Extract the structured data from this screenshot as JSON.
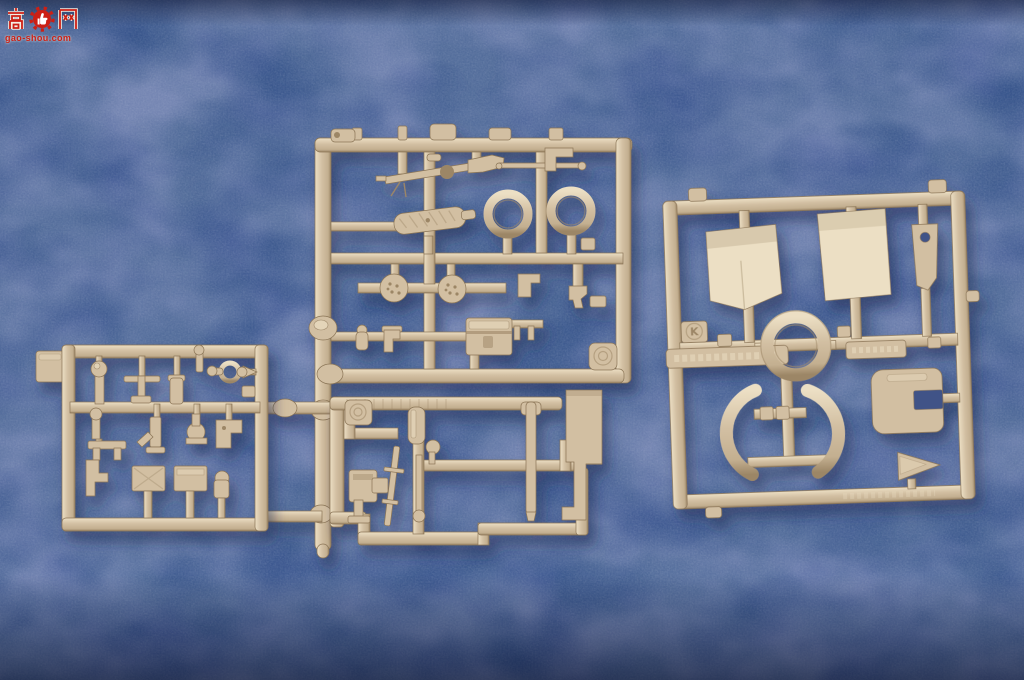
{
  "meta": {
    "scene": "Top-down photograph of four tan injection-moulded plastic model-kit sprues (part trees) lying on a blue textured paper background",
    "lighting": "soft light from upper-left, sprues cast soft blue shadows, darker vignette at top edge and bottom of photo"
  },
  "watermark": {
    "characters": "高网",
    "char_left": "高",
    "char_right": "网",
    "icon": "red gear with white thumbs-up",
    "site_text": "gao-shou.com"
  },
  "colors": {
    "bg_blue": "#4d639c",
    "bg_blue_light": "#7488b7",
    "bg_blue_dark": "#394e80",
    "bg_hole": "#3f5387",
    "sprue_base": "#d2bfa2",
    "sprue_hi": "#ecdfc4",
    "sprue_mid": "#c3af90",
    "sprue_shade": "#9c8666",
    "sprue_edge": "#8a7456",
    "shadow": "#1d2950",
    "watermark_red": "#cc1f14",
    "watermark_outline": "#f5efe4"
  },
  "sprues": {
    "top_center": {
      "letter": "",
      "description": "large square sprue with weapon and fitting parts, long runner extending down its left side to the other sprues",
      "parts": [
        "machine-gun",
        "thin-rod",
        "l-bracket",
        "cast-textured-muffler",
        "ring-hoop-left",
        "ring-hoop-right",
        "stippled-disc-left",
        "stippled-disc-right",
        "small-bracket",
        "hook-fitting",
        "periscope-elbow",
        "small-cylinder",
        "stowage-box",
        "pronged-bracket",
        "circular-mold-badge"
      ]
    },
    "left": {
      "letter": "",
      "description": "rectangular sprue of many small fittings with flat molding tab on its left edge",
      "parts": [
        "post-with-knob",
        "t-handle-tool",
        "capped-cylinder",
        "shell-with-ball",
        "tow-ring",
        "cone-fitting",
        "periscope-post",
        "twin-leg-bracket",
        "jack",
        "valve-fitting",
        "step-bracket",
        "zigzag-bracket",
        "stowage-box-1",
        "stowage-box-2",
        "dome-cylinder"
      ]
    },
    "bottom_center": {
      "letter": "",
      "description": "rectangular sprue with long rod and barrel parts and an L-shaped flat plate on its right side",
      "parts": [
        "circular-mold-badge",
        "angled-rod",
        "breech-block",
        "capped-cylinder",
        "ball-lever",
        "rod-with-ball",
        "gun-barrel",
        "l-shaped-plate"
      ]
    },
    "right": {
      "letter": "K",
      "description": "square sprue with flat hull plates, a large ring in the center, two crescent guards and a notched housing; embossed text bars on middle runner",
      "parts": [
        "trapezoid-plate",
        "square-panel",
        "slotted-bracket-with-hole",
        "large-ring",
        "crescent-guard-left",
        "crescent-guard-right",
        "notched-housing",
        "triangular-wedge"
      ]
    }
  }
}
